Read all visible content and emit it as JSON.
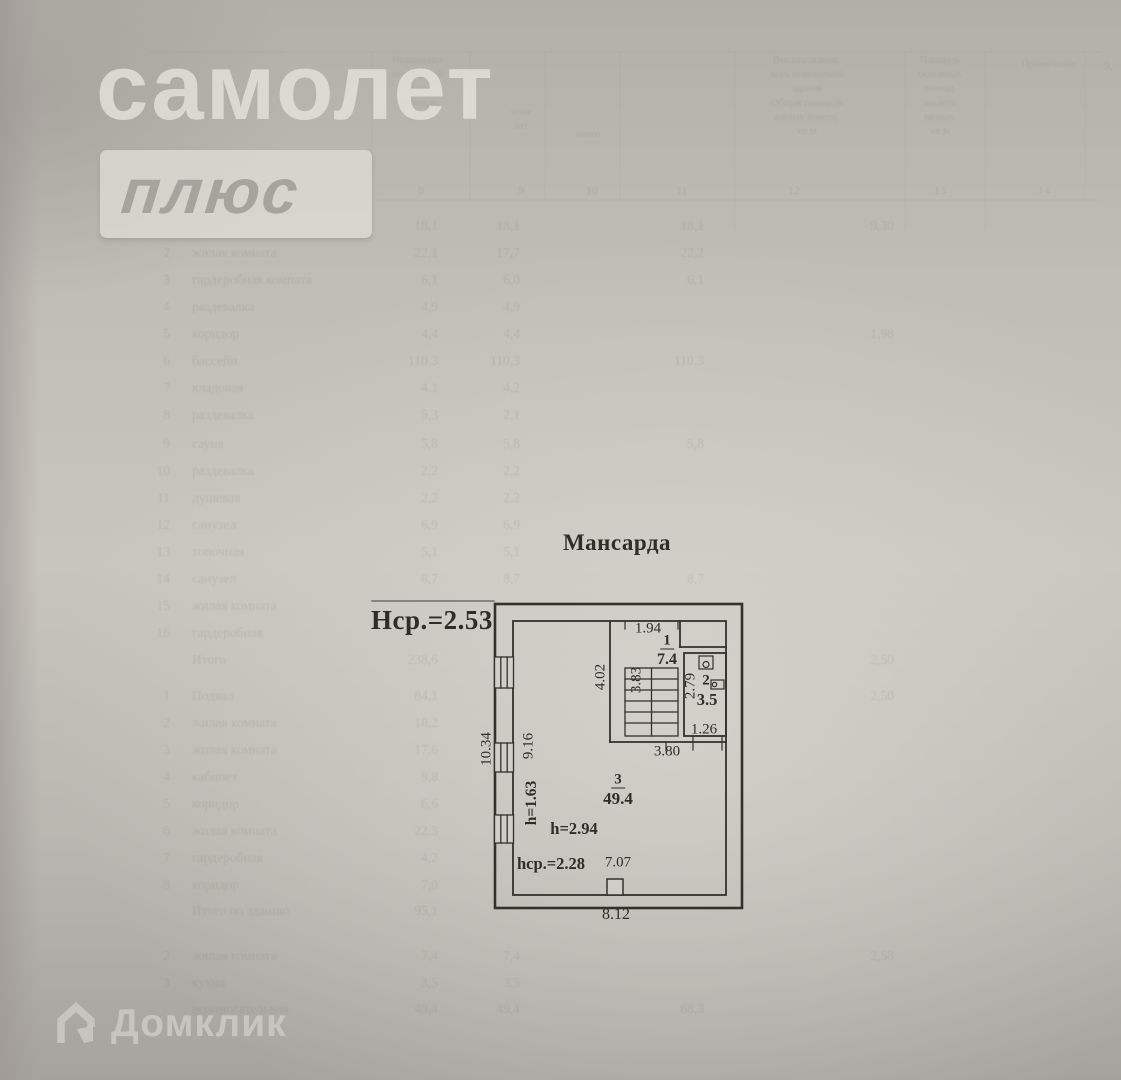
{
  "watermarks": {
    "brand_top": "самолет",
    "brand_badge": "плюс",
    "brand_bottom": "Домклик"
  },
  "plan": {
    "floor_title": "Мансарда",
    "avg_height_note": "Нср.=2.53",
    "rooms": [
      {
        "number": "1",
        "area": "7.4"
      },
      {
        "number": "2",
        "area": "3.5"
      },
      {
        "number": "3",
        "area": "49.4"
      }
    ],
    "dimensions": {
      "stair_top_width": "1.94",
      "stairwell_depth": "4.02",
      "stair_flight": "3.83",
      "room2_depth": "2.79",
      "room2_width": "1.26",
      "corridor_width": "3.80",
      "left_outer_length": "10.34",
      "left_inner_length": "9.16",
      "room3_width": "7.07",
      "bottom_outer_width": "8.12"
    },
    "heights": {
      "low_wall": "h=1.63",
      "main": "h=2.94",
      "average": "hср.=2.28"
    },
    "ink_color": "#33312d"
  },
  "ghost_table": {
    "corner_note": "9,",
    "header_blocks": [
      {
        "text": "Назначение\nпомещений\nи их\nплощадь\nкв.м",
        "x": 372,
        "y": 54,
        "w": 92
      },
      {
        "text": "этаж\nлит.",
        "x": 486,
        "y": 106,
        "w": 70
      },
      {
        "text": "итого",
        "x": 558,
        "y": 128,
        "w": 60
      },
      {
        "text": "Высота помещ.\nвсех помещений\nздания\nОбщая площадь\nжилых помещ.\nкв.м",
        "x": 732,
        "y": 54,
        "w": 150
      },
      {
        "text": "Площадь\nосновных\nпомещ.\nжилого\nназнач.\nкв.м",
        "x": 898,
        "y": 54,
        "w": 84
      },
      {
        "text": "Примечание",
        "x": 1006,
        "y": 58,
        "w": 86
      }
    ],
    "column_digits": [
      {
        "t": "8",
        "x": 418,
        "y": 183
      },
      {
        "t": "9",
        "x": 518,
        "y": 183
      },
      {
        "t": "10",
        "x": 586,
        "y": 183
      },
      {
        "t": "11",
        "x": 676,
        "y": 183
      },
      {
        "t": "12",
        "x": 788,
        "y": 183
      },
      {
        "t": "13",
        "x": 934,
        "y": 183
      },
      {
        "t": "14",
        "x": 1038,
        "y": 183
      }
    ],
    "rows": [
      {
        "y": 218,
        "num": "",
        "name": "",
        "v1": "18,1",
        "v2": "18,1",
        "v3": "18,1",
        "v4": "9,30"
      },
      {
        "y": 245,
        "num": "2",
        "name": "жилая комната",
        "v1": "22,1",
        "v2": "17,7",
        "v3": "22,2",
        "v4": ""
      },
      {
        "y": 272,
        "num": "3",
        "name": "гардеробная комната",
        "v1": "6,1",
        "v2": "6,0",
        "v3": "6,1",
        "v4": ""
      },
      {
        "y": 299,
        "num": "4",
        "name": "раздевалка",
        "v1": "4,9",
        "v2": "4,9",
        "v3": "",
        "v4": ""
      },
      {
        "y": 326,
        "num": "5",
        "name": "коридор",
        "v1": "4,4",
        "v2": "4,4",
        "v3": "",
        "v4": "1,98"
      },
      {
        "y": 353,
        "num": "6",
        "name": "бассейн",
        "v1": "110,3",
        "v2": "110,3",
        "v3": "110,3",
        "v4": ""
      },
      {
        "y": 380,
        "num": "7",
        "name": "кладовая",
        "v1": "4,1",
        "v2": "4,2",
        "v3": "",
        "v4": ""
      },
      {
        "y": 407,
        "num": "8",
        "name": "раздевалка",
        "v1": "5,3",
        "v2": "2,1",
        "v3": "",
        "v4": ""
      },
      {
        "y": 436,
        "num": "9",
        "name": "сауна",
        "v1": "5,8",
        "v2": "5,8",
        "v3": "5,8",
        "v4": ""
      },
      {
        "y": 463,
        "num": "10",
        "name": "раздевалка",
        "v1": "2,2",
        "v2": "2,2",
        "v3": "",
        "v4": ""
      },
      {
        "y": 490,
        "num": "11",
        "name": "душевая",
        "v1": "2,2",
        "v2": "2,2",
        "v3": "",
        "v4": ""
      },
      {
        "y": 517,
        "num": "12",
        "name": "санузел",
        "v1": "6,9",
        "v2": "6,9",
        "v3": "",
        "v4": ""
      },
      {
        "y": 544,
        "num": "13",
        "name": "топочная",
        "v1": "5,1",
        "v2": "5,1",
        "v3": "",
        "v4": ""
      },
      {
        "y": 571,
        "num": "14",
        "name": "санузел",
        "v1": "8,7",
        "v2": "8,7",
        "v3": "8,7",
        "v4": ""
      },
      {
        "y": 598,
        "num": "15",
        "name": "жилая комната",
        "v1": "",
        "v2": "",
        "v3": "",
        "v4": ""
      },
      {
        "y": 625,
        "num": "16",
        "name": "гардеробная",
        "v1": "",
        "v2": "",
        "v3": "",
        "v4": ""
      },
      {
        "y": 652,
        "num": "",
        "name": "Итого",
        "v1": "238,6",
        "v2": "",
        "v3": "",
        "v4": "2,50"
      },
      {
        "y": 688,
        "num": "1",
        "name": "Подвал",
        "v1": "84,1",
        "v2": "",
        "v3": "",
        "v4": "2,50"
      },
      {
        "y": 715,
        "num": "2",
        "name": "жилая комната",
        "v1": "18,2",
        "v2": "",
        "v3": "",
        "v4": ""
      },
      {
        "y": 742,
        "num": "3",
        "name": "жилая комната",
        "v1": "17,6",
        "v2": "",
        "v3": "",
        "v4": ""
      },
      {
        "y": 769,
        "num": "4",
        "name": "кабинет",
        "v1": "9,8",
        "v2": "",
        "v3": "",
        "v4": ""
      },
      {
        "y": 796,
        "num": "5",
        "name": "коридор",
        "v1": "6,6",
        "v2": "",
        "v3": "",
        "v4": ""
      },
      {
        "y": 823,
        "num": "6",
        "name": "жилая комната",
        "v1": "22,5",
        "v2": "",
        "v3": "",
        "v4": ""
      },
      {
        "y": 850,
        "num": "7",
        "name": "гардеробная",
        "v1": "4,2",
        "v2": "",
        "v3": "",
        "v4": ""
      },
      {
        "y": 877,
        "num": "8",
        "name": "коридор",
        "v1": "7,0",
        "v2": "",
        "v3": "",
        "v4": ""
      },
      {
        "y": 903,
        "num": "",
        "name": "Итого по зданию",
        "v1": "95,1",
        "v2": "",
        "v3": "",
        "v4": ""
      },
      {
        "y": 948,
        "num": "2",
        "name": "жилая комната",
        "v1": "7,4",
        "v2": "7,4",
        "v3": "",
        "v4": "2,58"
      },
      {
        "y": 975,
        "num": "3",
        "name": "кухня",
        "v1": "3,5",
        "v2": "3,5",
        "v3": "",
        "v4": ""
      },
      {
        "y": 1001,
        "num": "",
        "name": "вспомогательная",
        "v1": "49,4",
        "v2": "49,4",
        "v3": "68,3",
        "v4": ""
      }
    ]
  }
}
